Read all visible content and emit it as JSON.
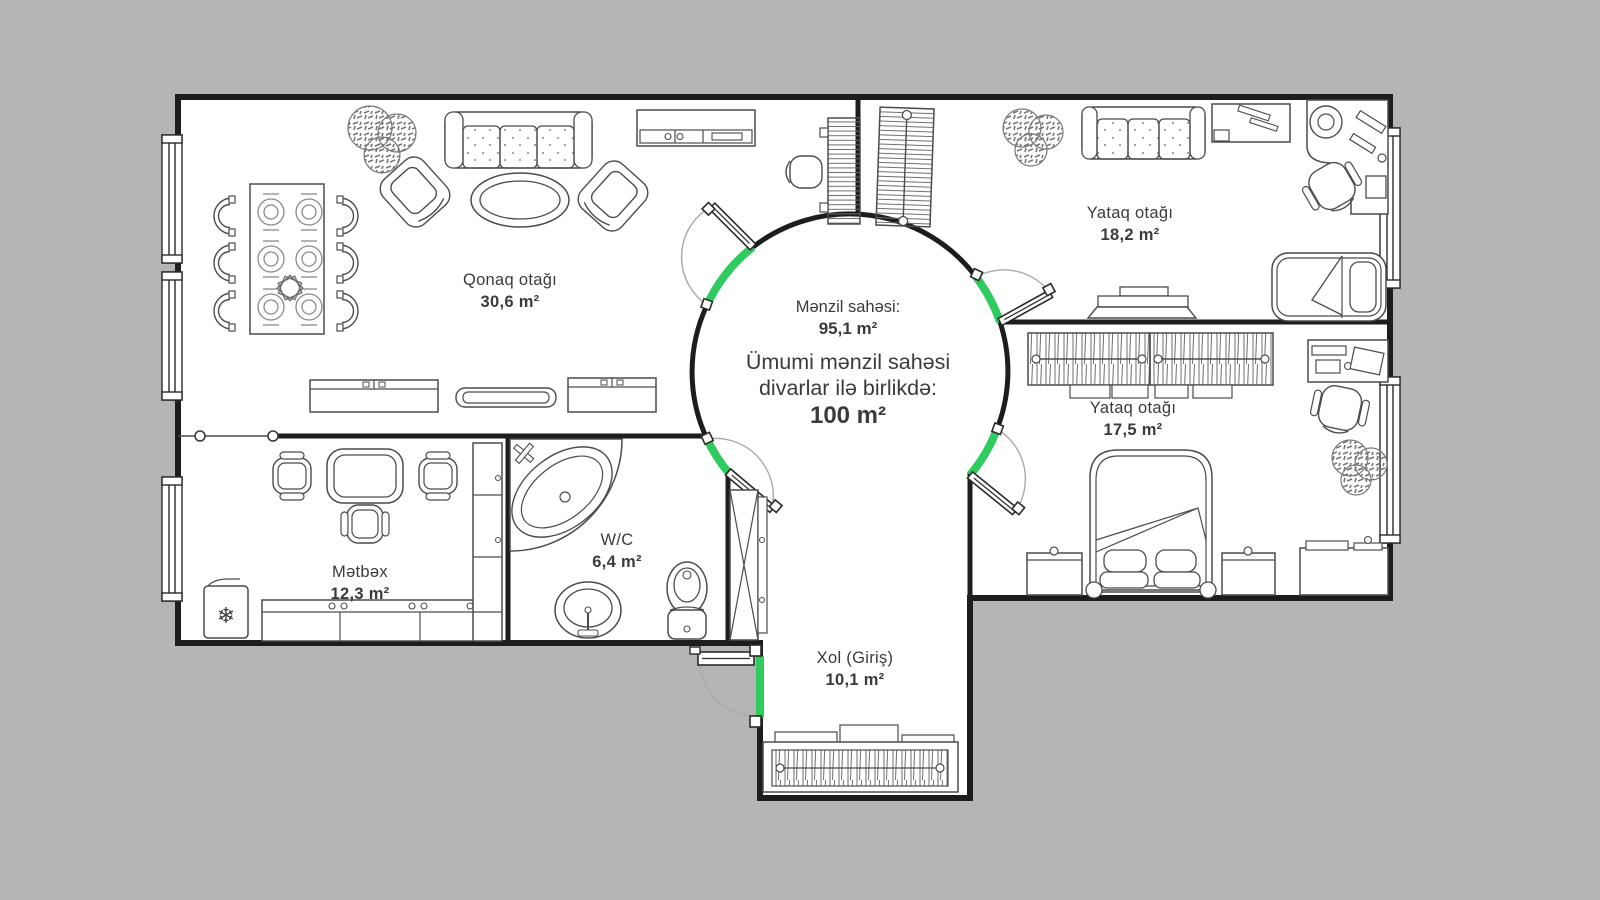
{
  "title": "Apartment floor plan",
  "colors": {
    "background": "#b5b5b5",
    "wall": "#1d1d1d",
    "floor": "#ffffff",
    "furniture_line": "#4c4c4c",
    "accent_green": "#2fcb5f",
    "text": "#3b3b3b"
  },
  "summary": {
    "line1": "Mənzil sahəsi:",
    "value1": "95,1 m²",
    "line2": "Ümumi mənzil sahəsi",
    "line3": "divarlar ilə birlikdə:",
    "value2": "100 m²"
  },
  "rooms": {
    "living": {
      "name": "Qonaq otağı",
      "area": "30,6 m²"
    },
    "bedroom1": {
      "name": "Yataq otağı",
      "area": "18,2 m²"
    },
    "bedroom2": {
      "name": "Yataq otağı",
      "area": "17,5 m²"
    },
    "kitchen": {
      "name": "Mətbəx",
      "area": "12,3 m²"
    },
    "wc": {
      "name": "W/C",
      "area": "6,4 m²"
    },
    "hall": {
      "name": "Xol (Giriş)",
      "area": "10,1 m²"
    }
  },
  "icons": {
    "snowflake": "❄"
  }
}
